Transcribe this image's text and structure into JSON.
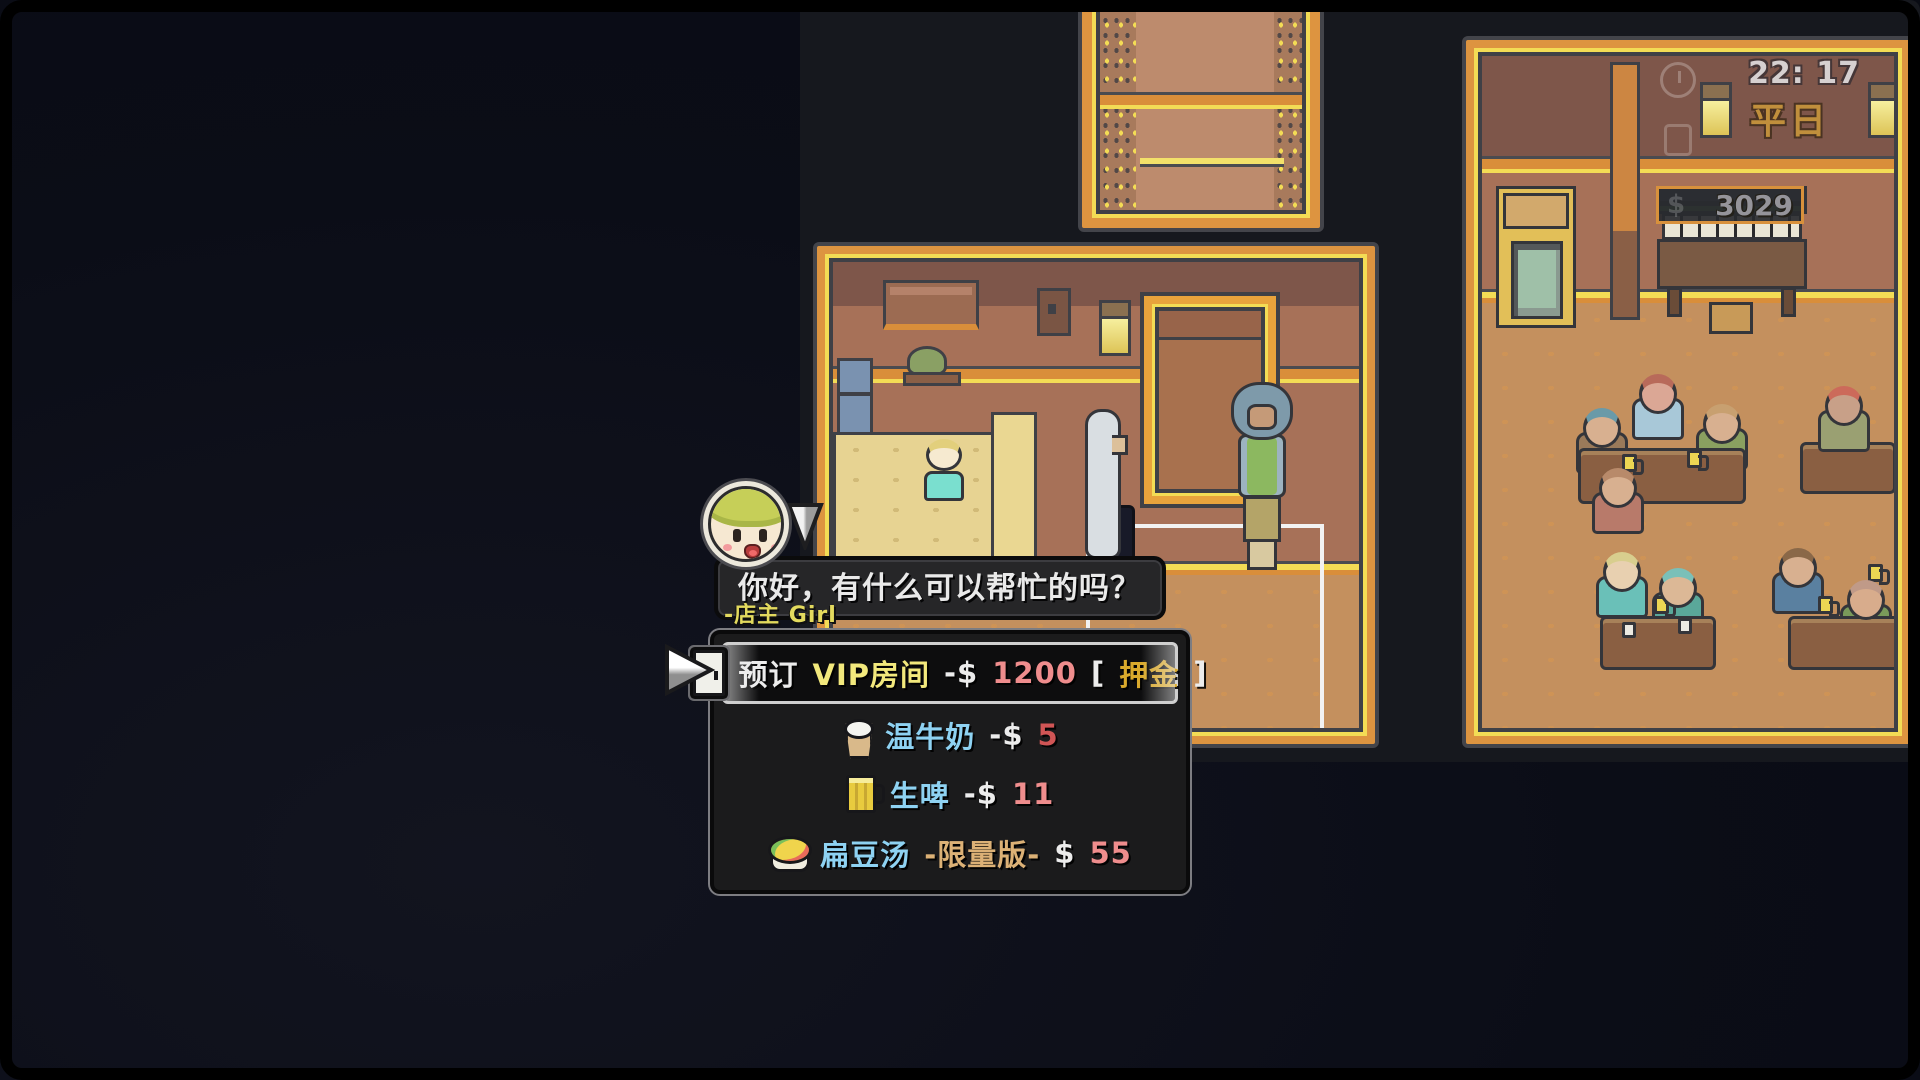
{
  "hud": {
    "time": "22: 17",
    "day": "平日",
    "money": "3029",
    "dollar_icon": "$",
    "icons": [
      "clock-outline-icon",
      "key-outline-icon",
      "dollar-outline-icon",
      "wall-lamp-icon"
    ]
  },
  "dialogue": {
    "speaker": "-店主 Girl",
    "text": "你好，有什么可以帮忙的吗？",
    "avatar": "shopkeeper-girl-portrait"
  },
  "menu": {
    "items": [
      {
        "name": "book-vip-room",
        "icon": "door-icon",
        "selected": true,
        "segments": [
          {
            "text": "预订",
            "color": "#ececec"
          },
          {
            "text": "VIP房间",
            "color": "#f2e87c"
          },
          {
            "text": "-$",
            "color": "#ececec"
          },
          {
            "text": "1200",
            "color": "#ef8d8d"
          },
          {
            "text": "[",
            "color": "#ececec"
          },
          {
            "text": "押金",
            "color": "#d9a92c"
          },
          {
            "text": "]",
            "color": "#ececec"
          }
        ]
      },
      {
        "name": "warm-milk",
        "icon": "milk-icon",
        "selected": false,
        "segments": [
          {
            "text": "温牛奶",
            "color": "#8ed2f2"
          },
          {
            "text": "-$",
            "color": "#ececec"
          },
          {
            "text": "5",
            "color": "#d05555"
          }
        ]
      },
      {
        "name": "draft-beer",
        "icon": "beer-icon",
        "selected": false,
        "segments": [
          {
            "text": "生啤",
            "color": "#8ed2f2"
          },
          {
            "text": "-$",
            "color": "#ececec"
          },
          {
            "text": "11",
            "color": "#ef8d8d"
          }
        ]
      },
      {
        "name": "lentil-soup-limited",
        "icon": "soup-icon",
        "selected": false,
        "segments": [
          {
            "text": "扁豆汤",
            "color": "#8ed2f2"
          },
          {
            "text": "-限量版-",
            "color": "#dcb176"
          },
          {
            "text": "$",
            "color": "#ececec"
          },
          {
            "text": "55",
            "color": "#ef8d8d"
          }
        ]
      }
    ]
  },
  "colors": {
    "background": "#0b0d17",
    "room_frame_orange": "#dd9440",
    "room_trim_yellow": "#f3dc55",
    "wall_brown": "#a77158",
    "floor_tan": "#c4905e",
    "menu_bg": "#1b1b1c",
    "selected_border": "#cfcfcf",
    "speaker_yellow": "#e3da5e",
    "hud_day_gold": "#c08f3c",
    "hud_money_gray": "#95949a",
    "highlight_rect_white": "#f2f2f2"
  }
}
